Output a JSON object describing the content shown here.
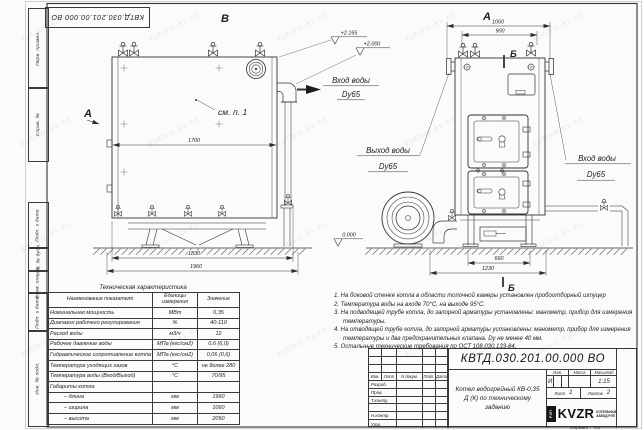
{
  "watermark": "kotlam-kv.kz",
  "doc": {
    "number": "КВТД.030.201.00.000 ВО",
    "name": "Котел водогрейный КВ-0,35 Д (К) по техническому заданию",
    "lit_value": "И",
    "scale_value": "1:15",
    "sheet_value": "1",
    "sheets_value": "2",
    "format_note": "Формат А3",
    "logo_text": "KVZR",
    "logo_emblem": "РЭП",
    "company_line1": "КОТЕЛЬНЫЙ",
    "company_line2": "ЗАВОД РЭП"
  },
  "title_block": {
    "col_izm": "Изм.",
    "col_list": "Лист",
    "col_doc": "N докум.",
    "col_sign": "Подп.",
    "col_date": "Дата",
    "row_developed": "Разраб.",
    "row_checked": "Пров.",
    "row_tcontrol": "Т.контр.",
    "row_ncontrol": "Н.контр.",
    "row_approved": "Утв.",
    "lit_label": "Лит.",
    "mass_label": "Масса",
    "scale_label": "Масштаб",
    "sheet_label": "Лист",
    "sheets_label": "Листов"
  },
  "frame_stamps": {
    "s1": "Перв. примен.",
    "s2": "Справ. №",
    "s3": "Подп. и дата",
    "s4": "Инв. № дубл.",
    "s5": "Взам. инв. №",
    "s6": "Подп. и дата",
    "s7": "Инв. № подл."
  },
  "views": {
    "label_front": "В",
    "label_side": "А",
    "label_section": "Б",
    "see_note": "см. п. 1",
    "inlet_label": "Вход воды",
    "outlet_label": "Выход воды",
    "dn_label": "Dy65",
    "elev_top": "+2.165",
    "elev_mid": "+2.000",
    "elev_zero": "0.000",
    "dim_1700": "1700",
    "dim_1830": "1830",
    "dim_1960": "1960",
    "dim_1060": "1060",
    "dim_900": "900",
    "dim_660": "660",
    "dim_1230": "1230"
  },
  "notes": [
    "1.  На боковой стенке котла в области топочной камеры установлен пробоотборный штуцер",
    "2.  Температура воды на входе 70°С, на выходе 95°С.",
    "3.  На подводящей трубе котла, до запорной арматуры установлены: манометр, прибор для измерения температуры.",
    "4.  На отводящей трубе котла, до запорной арматуры установлены: манометр, прибор для измерения температуры и два предохранительных клапана. Dy не менее 40 мм.",
    "5.  Остальные технические требования по ОСТ 108.030.133-84."
  ],
  "spec_table": {
    "title": "Техническая характеристика",
    "headers": [
      "Наименование показателя",
      "Единицы измерения",
      "Значение"
    ],
    "rows": [
      [
        "Номинальная мощность",
        "МВт",
        "0,35"
      ],
      [
        "Диапазон рабочего регулирования",
        "%",
        "40-110"
      ],
      [
        "Расход воды",
        "м3/ч",
        "12"
      ],
      [
        "Рабочее давление воды",
        "МПа (кгс/см2)",
        "0,6 (6,0)"
      ],
      [
        "Гидравлическое сопротивление котла",
        "МПа (кгс/см2)",
        "0,06 (0,6)"
      ],
      [
        "Температура уходящих газов",
        "°С",
        "не более 280"
      ],
      [
        "Температура воды (Вход/Выход)",
        "°С",
        "70/95"
      ],
      [
        "Габариты котла",
        "",
        ""
      ],
      [
        "– длина",
        "мм",
        "1960"
      ],
      [
        "– ширина",
        "мм",
        "1060"
      ],
      [
        "– высота",
        "мм",
        "2050"
      ]
    ]
  }
}
